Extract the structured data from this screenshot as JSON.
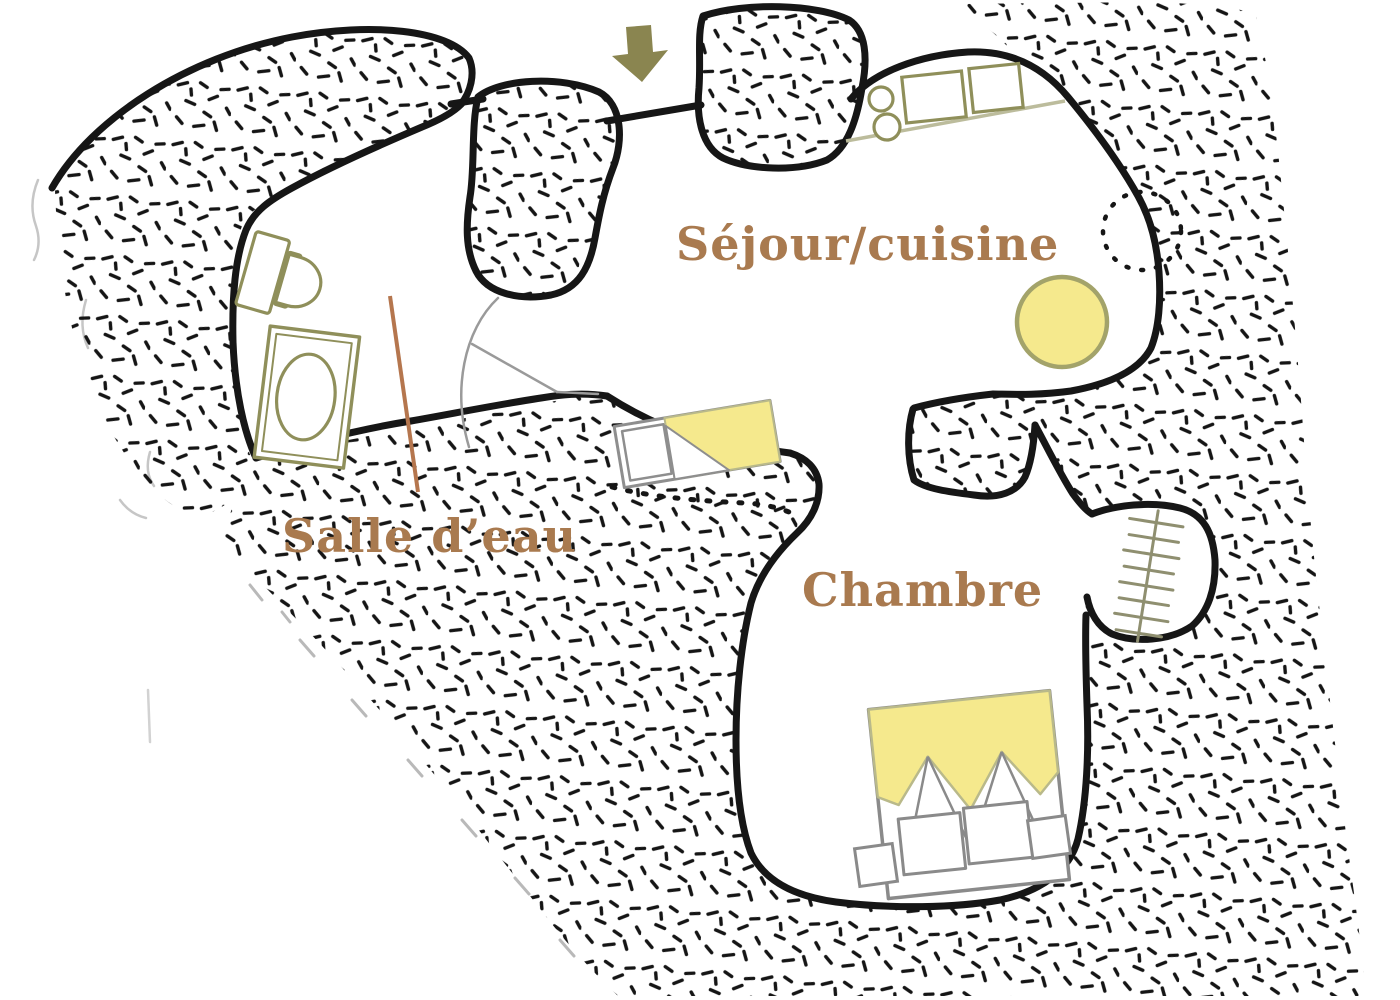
{
  "plan": {
    "type": "floor-plan",
    "rooms": [
      {
        "id": "sejour_cuisine",
        "label": "Séjour/cuisine"
      },
      {
        "id": "salle_deau",
        "label": "Salle d’eau"
      },
      {
        "id": "chambre",
        "label": "Chambre"
      }
    ],
    "icons": [
      "entrance-arrow-icon",
      "toilet-icon",
      "washing-machine-icon",
      "kitchen-hob-icon",
      "kitchen-sink-icon",
      "kitchen-counter-line",
      "round-table-icon",
      "window-dashed-circle-icon",
      "door-swing-icon",
      "ladder-icon",
      "single-bed-icon",
      "double-bed-icon",
      "nightstand-icon"
    ],
    "colors": {
      "label_text": "#a97a4f",
      "leader_line": "#b5764e",
      "arrow_olive": "#8a8550",
      "furniture_olive": "#8f8f5a",
      "furniture_gray": "#8a8a8a",
      "highlight_yellow": "#f5e98d",
      "counter_line": "#bcbc9c",
      "wall_black": "#161616",
      "ladder_gray": "#8f8f70",
      "faint_gray": "#c6c6c6"
    }
  }
}
